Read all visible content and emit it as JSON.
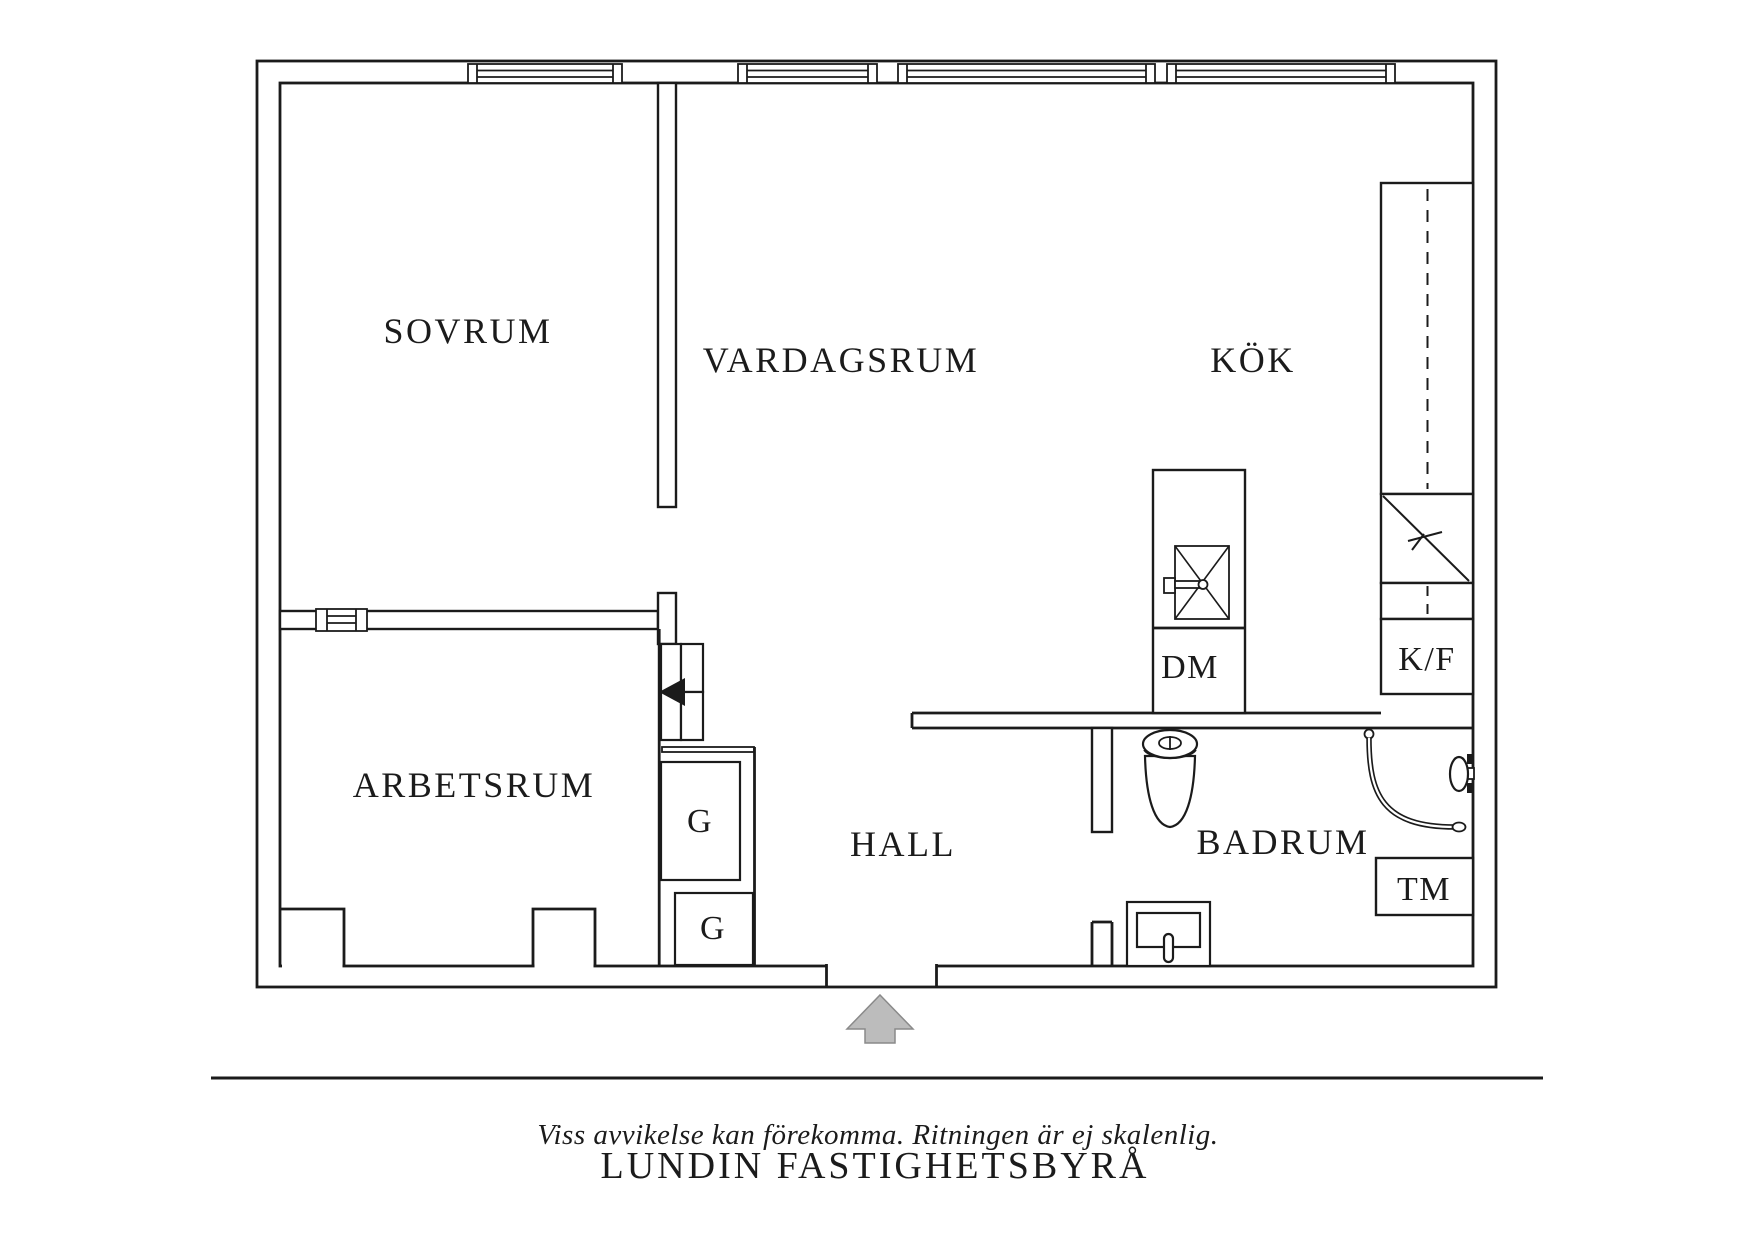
{
  "rooms": {
    "sovrum": "SOVRUM",
    "vardagsrum": "VARDAGSRUM",
    "kok": "KÖK",
    "arbetsrum": "ARBETSRUM",
    "hall": "HALL",
    "badrum": "BADRUM"
  },
  "fixtures": {
    "dishwasher": "DM",
    "fridge_freezer": "K/F",
    "washing_machine": "TM",
    "wardrobe_1": "G",
    "wardrobe_2": "G"
  },
  "footer": {
    "disclaimer": "Viss avvikelse kan förekomma. Ritningen är ej skalenlig.",
    "brand": "LUNDIN FASTIGHETSBYRÅ"
  },
  "colors": {
    "background": "#ffffff",
    "line": "#1b1b1b",
    "entrance_arrow_fill": "#bcbcbc",
    "entrance_arrow_outline": "#8a8a8a"
  }
}
